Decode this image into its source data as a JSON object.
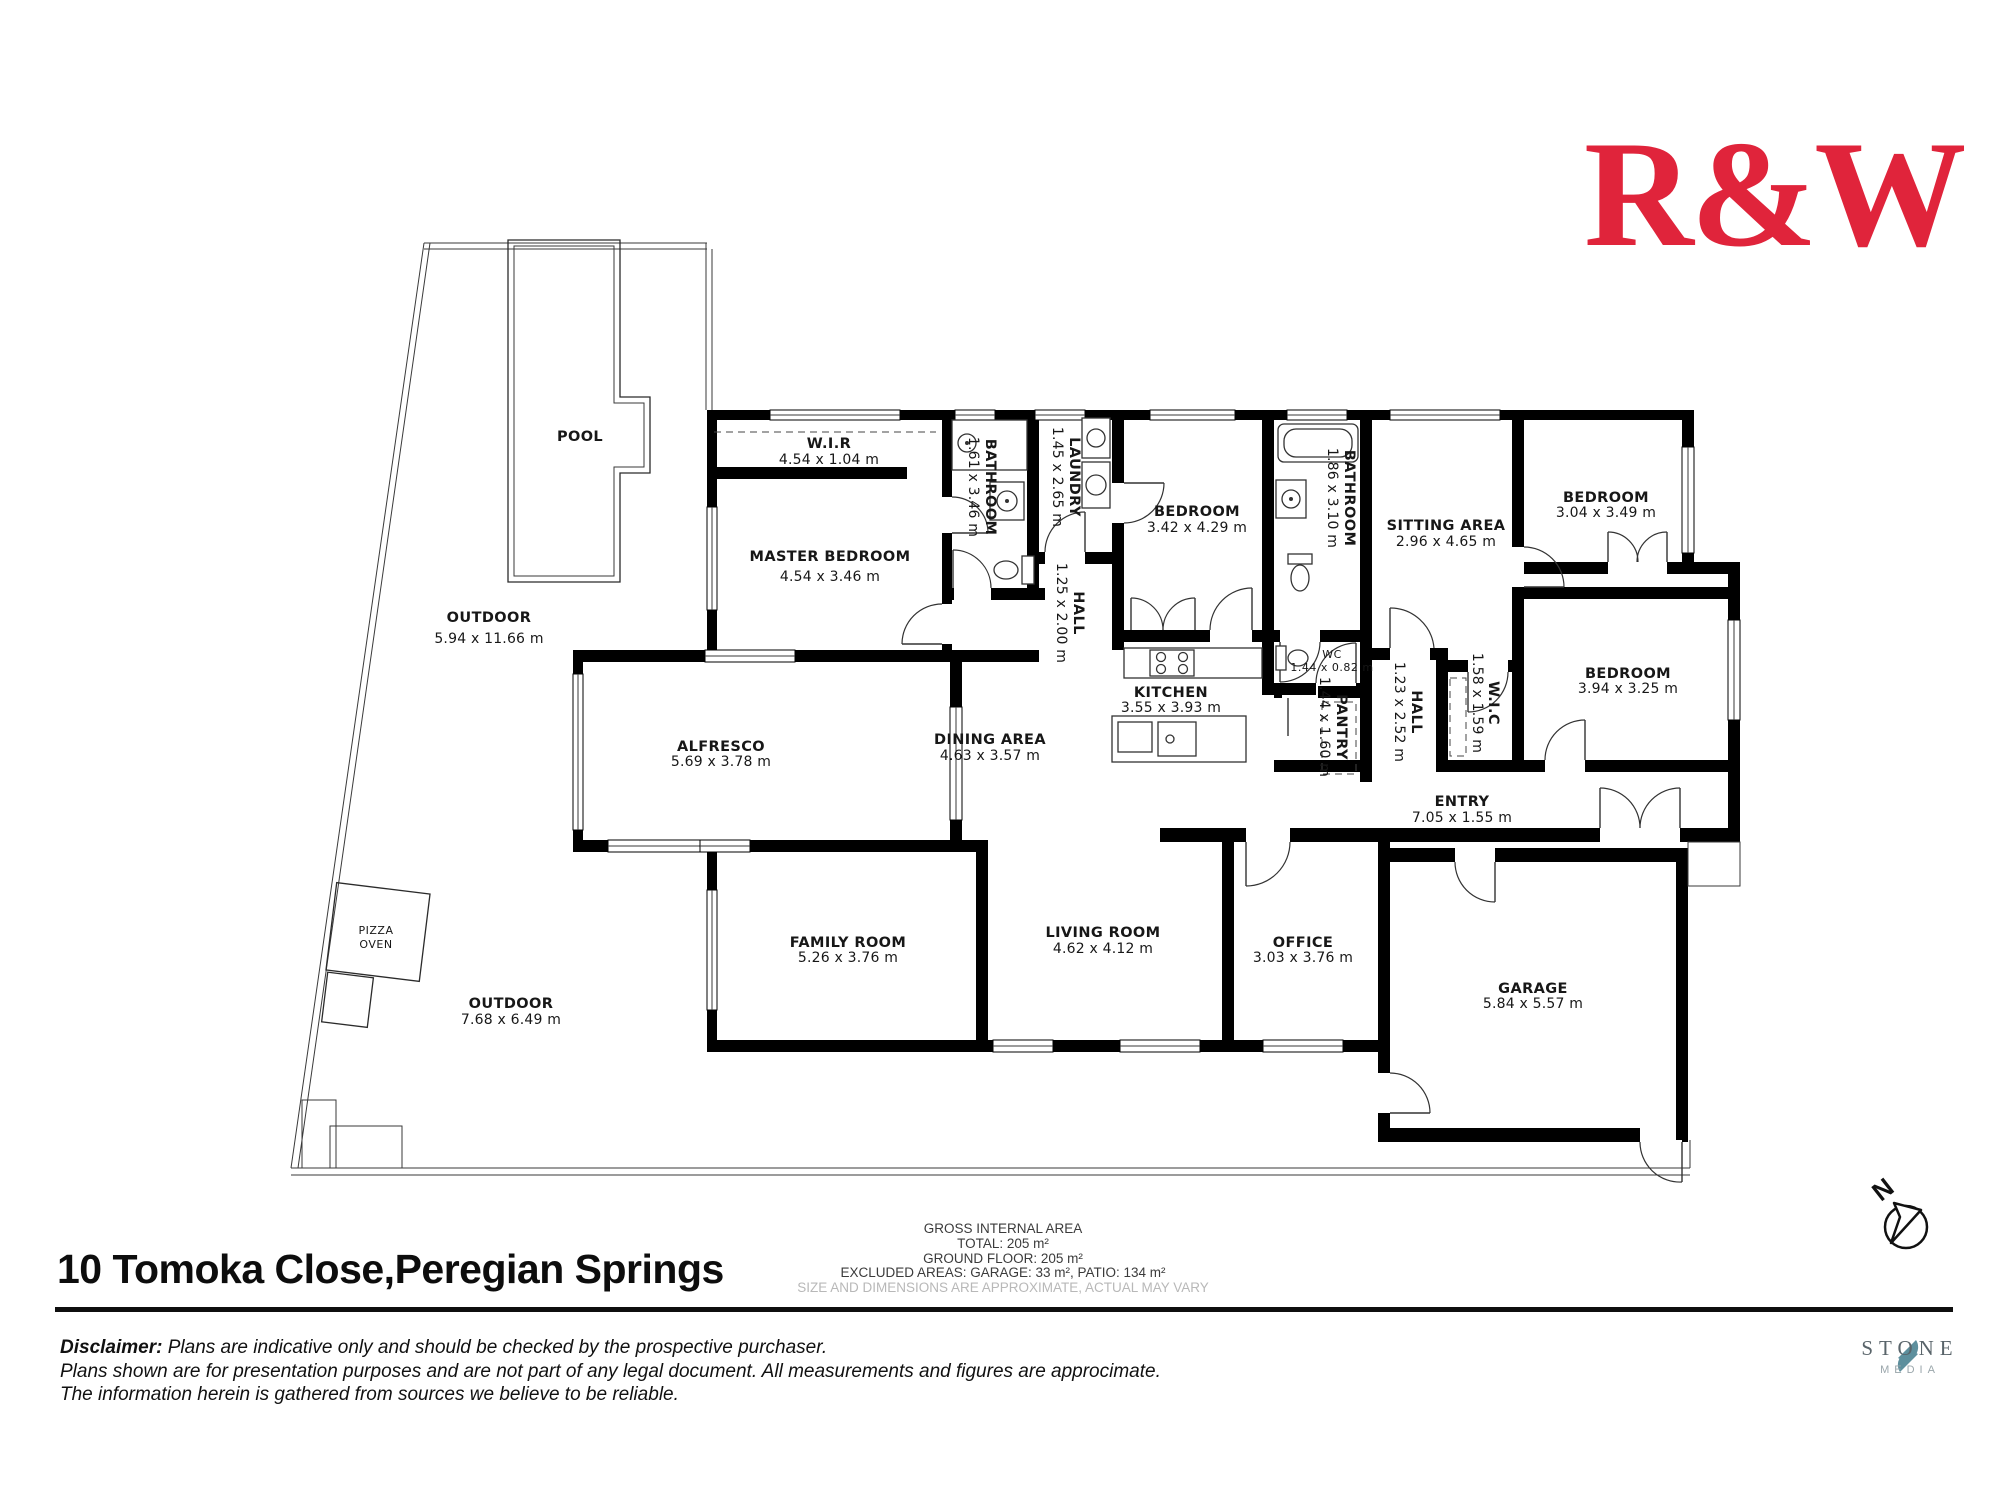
{
  "brand": {
    "logo_text": "R&W",
    "color": "#e0243b"
  },
  "plan": {
    "pool_label": "POOL",
    "pizza_oven": {
      "line1": "PIZZA",
      "line2": "OVEN"
    },
    "rooms": [
      {
        "name": "OUTDOOR",
        "dims": "5.94 x 11.66 m"
      },
      {
        "name": "W.I.R",
        "dims": "4.54 x 1.04 m"
      },
      {
        "name": "MASTER BEDROOM",
        "dims": "4.54 x 3.46 m"
      },
      {
        "name": "BATHROOM",
        "dims": "1.61 x 3.46 m"
      },
      {
        "name": "LAUNDRY",
        "dims": "1.45 x 2.65 m"
      },
      {
        "name": "HALL",
        "dims": "1.25 x 2.00 m"
      },
      {
        "name": "BEDROOM",
        "dims": "3.42 x 4.29 m"
      },
      {
        "name": "BATHROOM",
        "dims": "1.86 x 3.10 m"
      },
      {
        "name": "SITTING AREA",
        "dims": "2.96 x 4.65 m"
      },
      {
        "name": "BEDROOM",
        "dims": "3.04 x 3.49 m"
      },
      {
        "name": "BEDROOM",
        "dims": "3.94 x 3.25 m"
      },
      {
        "name": "W.I.C",
        "dims": "1.58 x 1.59 m"
      },
      {
        "name": "HALL",
        "dims": "1.23 x 2.52 m"
      },
      {
        "name": "KITCHEN",
        "dims": "3.55 x 3.93 m"
      },
      {
        "name": "WC",
        "dims": "1.44 x 0.82 m"
      },
      {
        "name": "PANTRY",
        "dims": "1.44 x 1.60 m"
      },
      {
        "name": "DINING AREA",
        "dims": "4.63 x 3.57 m"
      },
      {
        "name": "ALFRESCO",
        "dims": "5.69 x 3.78 m"
      },
      {
        "name": "ENTRY",
        "dims": "7.05 x 1.55 m"
      },
      {
        "name": "FAMILY ROOM",
        "dims": "5.26 x 3.76 m"
      },
      {
        "name": "LIVING ROOM",
        "dims": "4.62 x 4.12 m"
      },
      {
        "name": "OFFICE",
        "dims": "3.03 x 3.76 m"
      },
      {
        "name": "GARAGE",
        "dims": "5.84 x 5.57 m"
      },
      {
        "name": "OUTDOOR",
        "dims": "7.68 x 6.49 m"
      }
    ]
  },
  "compass": {
    "label": "N"
  },
  "footer": {
    "address": "10 Tomoka Close,Peregian Springs",
    "disclaimer_label": "Disclaimer:",
    "disclaimer_line1": " Plans are indicative only and should be checked by the prospective purchaser.",
    "disclaimer_line2": "Plans shown are for presentation purposes and are not part of any legal document. All measurements and figures are approcimate.",
    "disclaimer_line3": "The information herein is gathered from sources we believe to be reliable."
  },
  "area_summary": {
    "title": "GROSS INTERNAL AREA",
    "total": "TOTAL: 205 m²",
    "ground_floor": "GROUND FLOOR: 205 m²",
    "excluded": "EXCLUDED AREAS: GARAGE: 33 m², PATIO: 134 m²",
    "note": "SIZE AND DIMENSIONS ARE APPROXIMATE, ACTUAL MAY VARY"
  },
  "media": {
    "name": "STONE",
    "sub": "MEDIA"
  }
}
